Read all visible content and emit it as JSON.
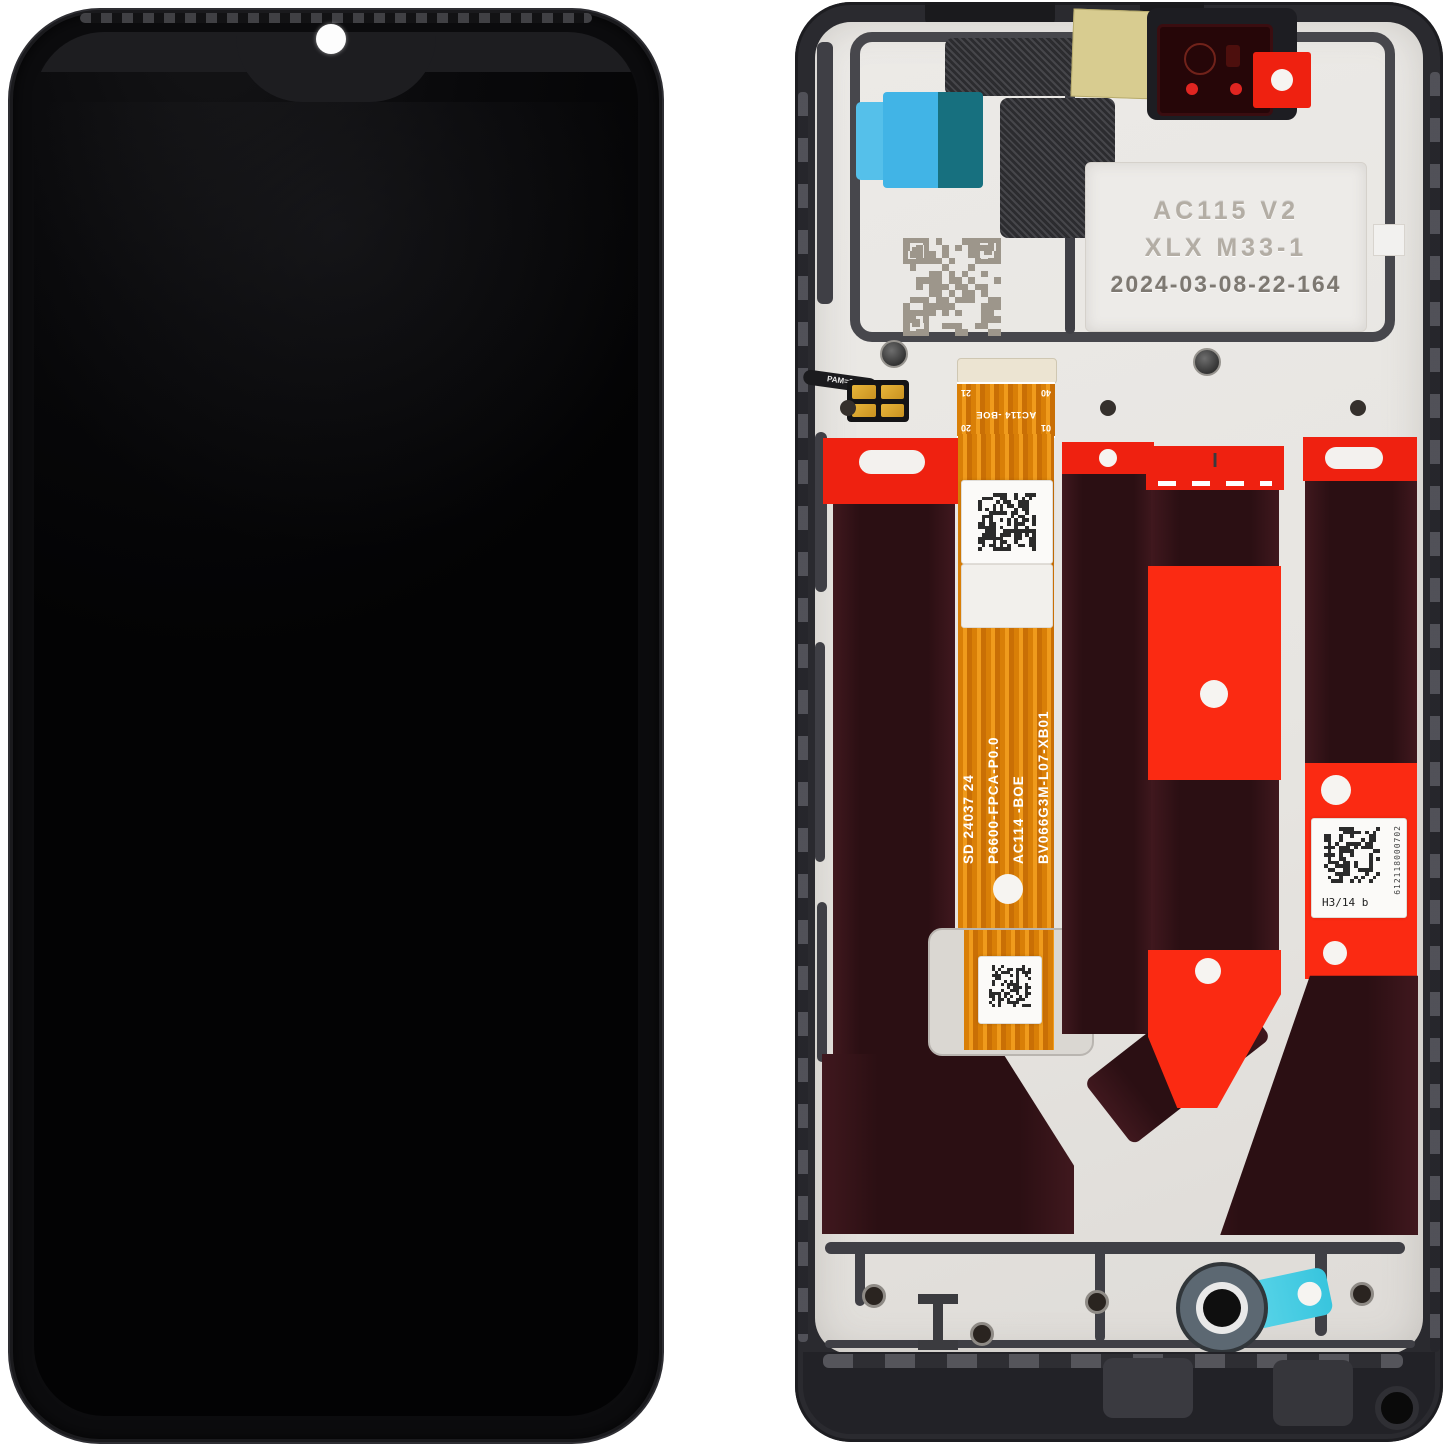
{
  "colors": {
    "adhesive-red": "#ef2110",
    "adhesive-red-bright": "#fb2a12",
    "panel-maroon": "#2b0f13",
    "flex-orange": "#e6890f",
    "tab-blue": "#41b4e6",
    "tab-teal": "#17707f",
    "kapton-yellow": "#d8cc90",
    "pull-tab-cyan": "#38c5de",
    "plate-silver": "#e9e7e3",
    "frame-dark": "#2a2a2f"
  },
  "back_module": {
    "engraved_label": {
      "line1": "AC115 V2",
      "line2": "XLX M33-1",
      "line3": "2024-03-08-22-164"
    },
    "main_flex_lines": [
      "BV066G3M-L07-XB01",
      "AC114 -BOE",
      "P6600-FPCA-P0.0",
      "SD 24037 24"
    ],
    "connector_flex": {
      "label": "AC114 -BOE",
      "pins": [
        "01",
        "20",
        "40",
        "21"
      ]
    },
    "pad_flex_label": "PAM=0",
    "serial_label": {
      "text": "H3/14 b",
      "serial": "612118000702"
    },
    "markings": {
      "header_mark": "I",
      "plate_mark": "I"
    }
  }
}
